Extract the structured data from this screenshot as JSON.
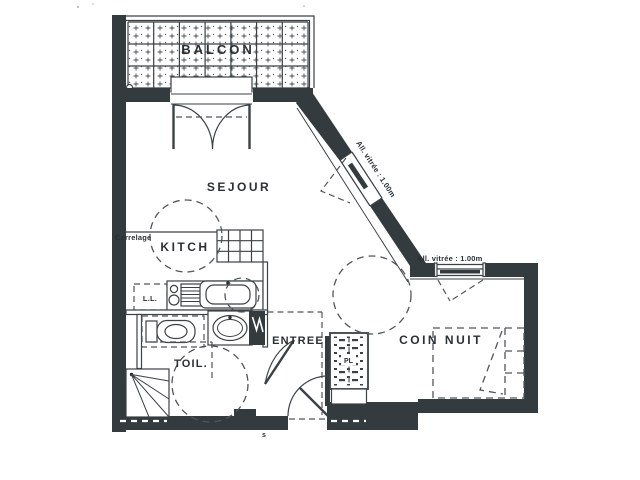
{
  "plan": {
    "rooms": {
      "balcon": "BALCON",
      "sejour": "SEJOUR",
      "kitch": "KITCH",
      "toil": "TOIL.",
      "entree": "ENTREE",
      "coin_nuit": "COIN NUIT"
    },
    "labels": {
      "carrelage": "Carrelage",
      "washing_machine": "L.L.",
      "closet": "PL",
      "sill_diagonal": "All. vitrée : 1.00m",
      "sill_bedroom": "All. vitrée : 1.00m",
      "door_mark": "s"
    },
    "colors": {
      "wall": "#333b3f",
      "line": "#3b4145",
      "dash": "#50565a",
      "paper": "#ffffff",
      "text": "#2b3034"
    }
  }
}
